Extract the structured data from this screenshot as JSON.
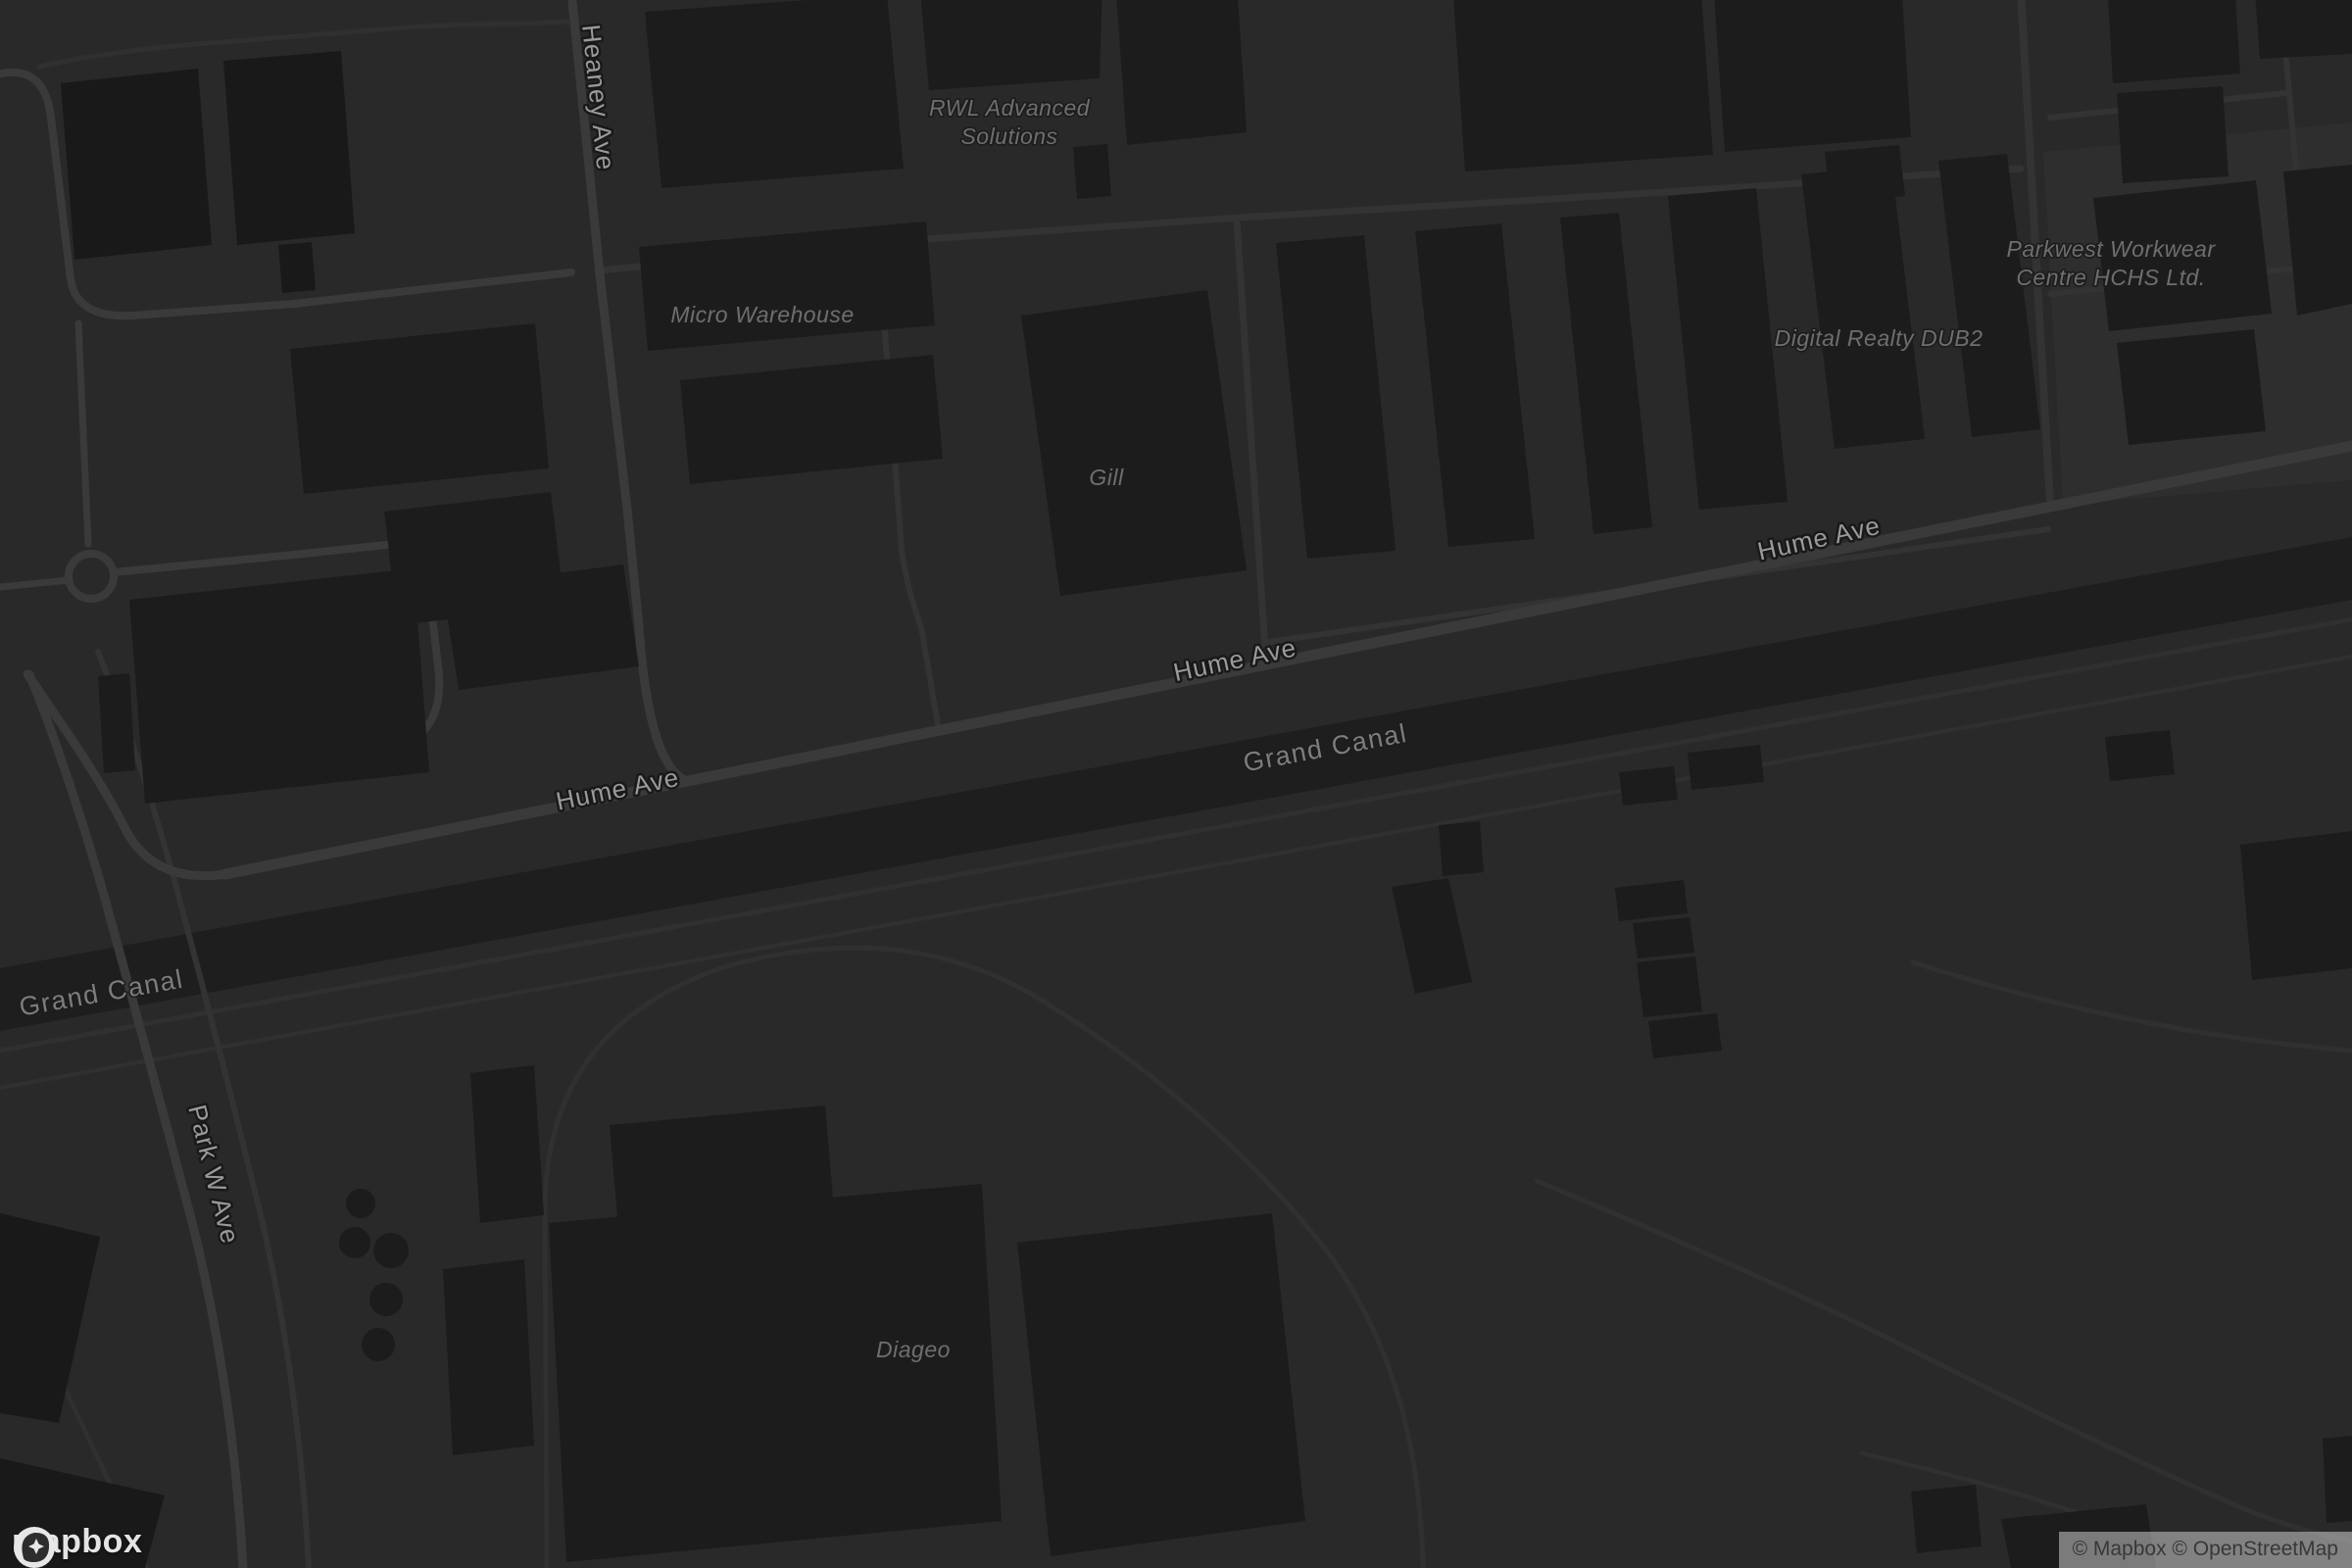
{
  "colors": {
    "background": "#292929",
    "building": "#1c1c1c",
    "building_dark": "#191919",
    "landuse_light": "#2e2e2e",
    "road_major": "#3a3a3a",
    "road_minor": "#333333",
    "path": "#303030",
    "canal_water": "#1e1e1e",
    "street_label": "#9a9a9a",
    "water_label": "#7d7d7d",
    "poi_label": "#6e6e6e",
    "label_halo": "#191919",
    "logo_color": "#e4e4e4",
    "attribution_text": "#383838"
  },
  "branding": {
    "logo_text": "mapbox"
  },
  "attribution": {
    "text": "© Mapbox © OpenStreetMap"
  },
  "map": {
    "street_labels": [
      {
        "id": "heaney-ave",
        "text": "Heaney Ave"
      },
      {
        "id": "hume-ave-west",
        "text": "Hume Ave"
      },
      {
        "id": "hume-ave-mid",
        "text": "Hume Ave"
      },
      {
        "id": "hume-ave-east",
        "text": "Hume Ave"
      },
      {
        "id": "park-w-ave",
        "text": "Park W Ave"
      }
    ],
    "water_labels": [
      {
        "id": "grand-canal-west",
        "text": "Grand Canal"
      },
      {
        "id": "grand-canal-mid",
        "text": "Grand Canal"
      }
    ],
    "poi_labels": [
      {
        "id": "rwl-advanced-solutions",
        "lines": [
          "RWL Advanced",
          "Solutions"
        ]
      },
      {
        "id": "micro-warehouse",
        "lines": [
          "Micro Warehouse"
        ]
      },
      {
        "id": "gill",
        "lines": [
          "Gill"
        ]
      },
      {
        "id": "digital-realty-dub2",
        "lines": [
          "Digital Realty DUB2"
        ]
      },
      {
        "id": "parkwest-workwear",
        "lines": [
          "Parkwest Workwear",
          "Centre HCHS Ltd."
        ]
      },
      {
        "id": "diageo",
        "lines": [
          "Diageo"
        ]
      }
    ]
  }
}
